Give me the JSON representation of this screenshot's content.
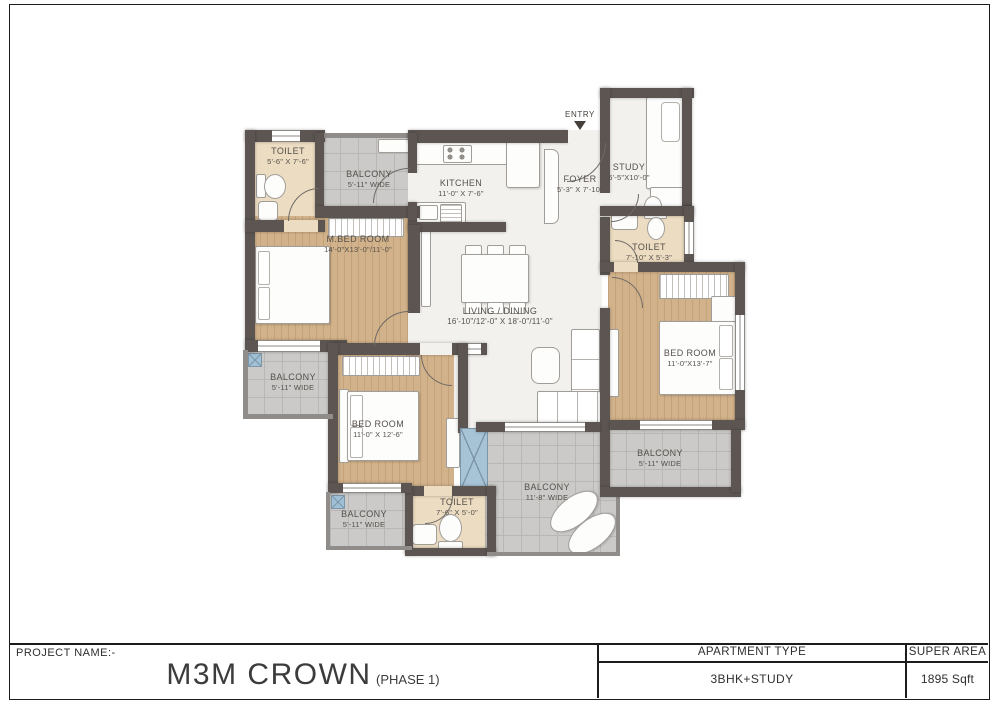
{
  "title_block": {
    "project_name_label": "PROJECT NAME:-",
    "project_name": "M3M CROWN",
    "phase": "(PHASE 1)",
    "apartment_type_label": "APARTMENT TYPE",
    "apartment_type_value": "3BHK+STUDY",
    "super_area_label": "SUPER AREA",
    "super_area_value": "1895 Sqft"
  },
  "plan": {
    "entry_label": "ENTRY",
    "rooms": {
      "toilet1": {
        "label": "TOILET",
        "dims": "5'-6\" X 7'-6\""
      },
      "balconyTop": {
        "label": "BALCONY",
        "dims": "5'-11\" WIDE"
      },
      "kitchen": {
        "label": "KITCHEN",
        "dims": "11'-0\" X 7'-6\""
      },
      "foyer": {
        "label": "FOYER",
        "dims": "5'-3\" X 7'-10\""
      },
      "study": {
        "label": "STUDY",
        "dims": "6'-5\"X10'-0\""
      },
      "toilet2": {
        "label": "TOILET",
        "dims": "7'-10\" X 5'-3\""
      },
      "mBedroom": {
        "label": "M.BED ROOM",
        "dims": "14'-0\"X13'-0\"/11'-0\""
      },
      "living": {
        "label": "LIVING / DINING",
        "dims": "16'-10\"/12'-0\" X 18'-0\"/11'-0\""
      },
      "bedroomRight": {
        "label": "BED ROOM",
        "dims": "11'-0\"X13'-7\""
      },
      "balconyLeft": {
        "label": "BALCONY",
        "dims": "5'-11\" WIDE"
      },
      "bedroom2": {
        "label": "BED ROOM",
        "dims": "11'-0\" X 12'-6\""
      },
      "balconyBottomLeft": {
        "label": "BALCONY",
        "dims": "5'-11\" WIDE"
      },
      "toilet3": {
        "label": "TOILET",
        "dims": "7'-6\" X 5'-0\""
      },
      "balconyBottomMid": {
        "label": "BALCONY",
        "dims": "11'-8\" WIDE"
      },
      "balconyRight": {
        "label": "BALCONY",
        "dims": "5'-11\" WIDE"
      }
    }
  },
  "colors": {
    "wall": "#5c5552",
    "wood_floor": "#d2b28a",
    "tile_floor": "#cbcac8",
    "bath_floor": "#ecdcc1",
    "living_floor": "#f3f1ee",
    "glazing": "#a7c3d6",
    "label_text": "#55504b",
    "frame_border": "#1c1c1c"
  }
}
